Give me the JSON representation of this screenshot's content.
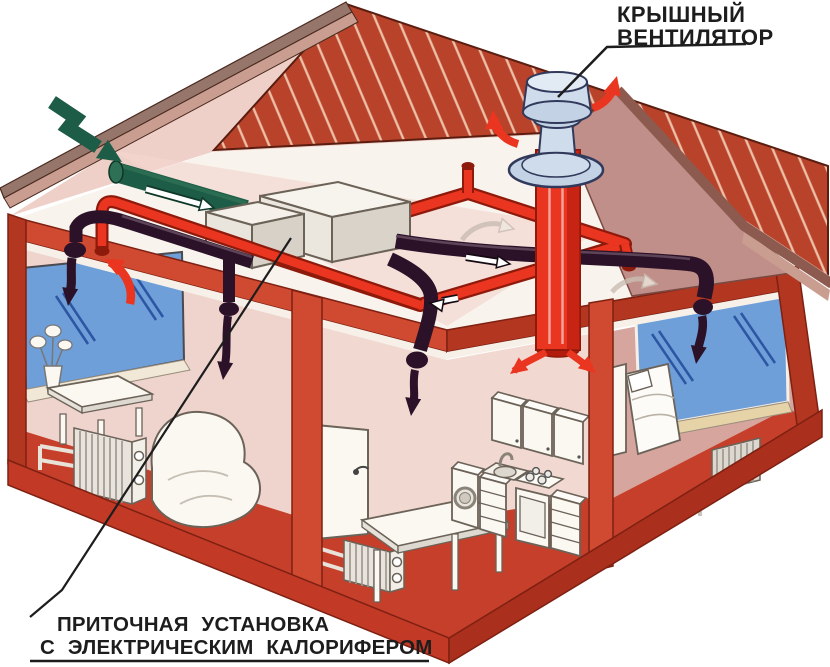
{
  "labels": {
    "roof_fan": {
      "line1": "КРЫШНЫЙ",
      "line2": "ВЕНТИЛЯТОР"
    },
    "supply_unit": {
      "line1": "ПРИТОЧНАЯ УСТАНОВКА",
      "line2": "С ЭЛЕКТРИЧЕСКИМ КАЛОРИФЕРОМ"
    }
  },
  "parts": [
    "roof-ventilator",
    "exhaust-riser-duct",
    "exhaust-duct-ring",
    "supply-unit",
    "supply-ducts",
    "intake-air-arrow",
    "intake-duct",
    "room-left",
    "room-middle",
    "kitchen",
    "bedroom",
    "radiators",
    "windows",
    "roof"
  ],
  "colors": {
    "paper": "#ffffff",
    "ink": "#1d1d1d",
    "roof-red": "#b8432a",
    "roof-hatch": "#ecbfa6",
    "roof-edge": "#5a1d10",
    "beam-brown": "#96756a",
    "beam-pink": "#c99e90",
    "rake-brown": "#8d5a50",
    "gable-mauve": "#c08f89",
    "underroof-pink": "#efd0c9",
    "attic-white": "#f8f3ec",
    "frame-red": "#d04a31",
    "frame-dark": "#b23620",
    "frame-outline": "#7e2012",
    "wall-pink": "#eed4cd",
    "wall-pink2": "#f1d8d1",
    "wall-mauve": "#d6a59e",
    "floor-red": "#c63f2a",
    "base-red": "#c23a26",
    "base-dark": "#aa2f1c",
    "window-blue": "#6f9fd8",
    "window-line": "#2c55a4",
    "sill-cream": "#f2e8d8",
    "sill-gold": "#e6d3a8",
    "duct-dark": "#2b1228",
    "duct-dark-hi": "#644a5e",
    "duct-red": "#ea3620",
    "duct-red-dark": "#8e1a0c",
    "duct-red-shade": "#b31b0c",
    "green": "#1d5c46",
    "green-dark": "#10382a",
    "vent-body": "#cfdceb",
    "vent-light": "#e2eaf4",
    "vent-shade": "#c3d2e4",
    "vent-outline": "#323a5c",
    "furniture-white": "#fbf8f2",
    "furniture-line": "#6b6258"
  }
}
